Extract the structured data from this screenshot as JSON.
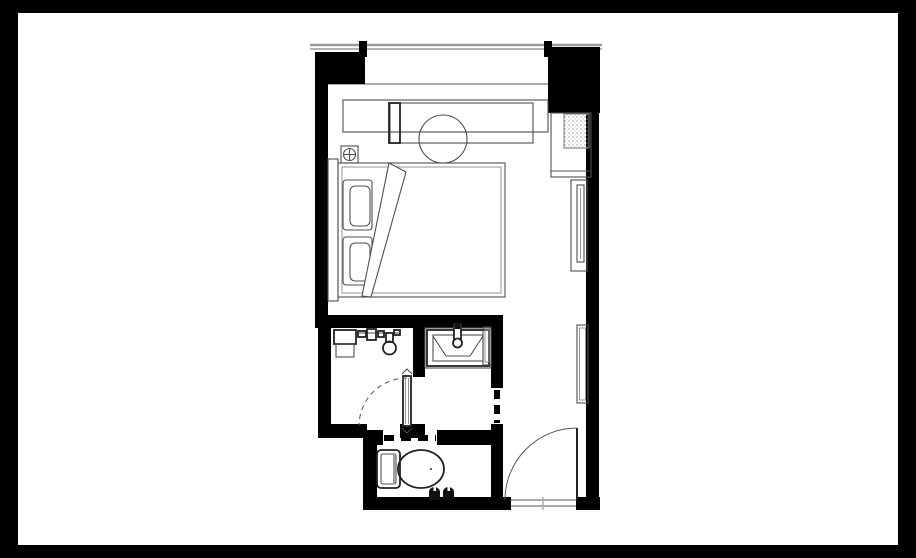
{
  "meta": {
    "title": "Hotel guest room floor plan",
    "description": "Black-and-white architectural floor plan of a studio hotel guest room: bedroom with bed, desk and window wall at top; minibar cabinet and TV on the right wall; shower room, vanity vestibule and toilet room at lower left; entry door with swing arc at lower right."
  },
  "colors": {
    "page_frame": "#000000",
    "canvas": "#ffffff",
    "wall": "#000000",
    "furniture_line": "#4f4f4f",
    "dark_fixture_line": "#222222",
    "glass_line": "#9a9a9a",
    "stipple": "#9a9a9a"
  },
  "rooms": [
    {
      "name": "bedroom"
    },
    {
      "name": "shower-room"
    },
    {
      "name": "vanity-vestibule"
    },
    {
      "name": "toilet-room"
    },
    {
      "name": "entry-corridor"
    }
  ],
  "fixtures": [
    "window-wall",
    "window-mullions",
    "console-shelf",
    "desk",
    "stool",
    "floor-outlet-symbol",
    "headboard",
    "bed",
    "pillows",
    "sheet-fold",
    "minibar-cabinet",
    "tv-panel",
    "wall-mirror",
    "entry-door",
    "shower-bench",
    "shower-controls",
    "hand-shower",
    "glass-shower-door",
    "vanity-counter",
    "vessel-sink",
    "faucet",
    "mirror-panel",
    "sliding-door",
    "toilet",
    "slippers"
  ]
}
